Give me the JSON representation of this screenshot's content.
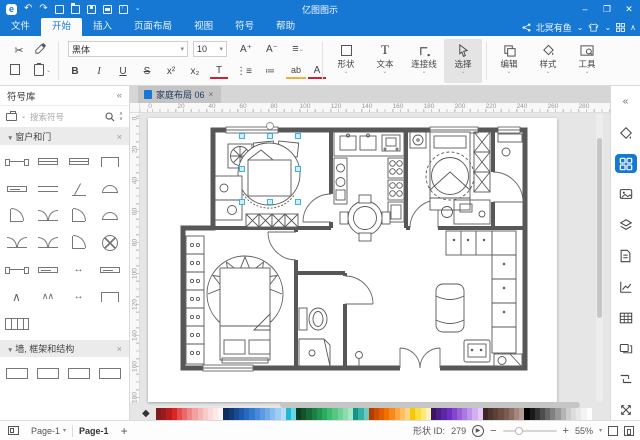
{
  "titlebar": {
    "title": "亿图图示",
    "minimize": "–",
    "maximize": "❐",
    "close": "✕",
    "undo": "↶",
    "redo": "↷"
  },
  "menubar": {
    "tabs": [
      "文件",
      "开始",
      "插入",
      "页面布局",
      "视图",
      "符号",
      "帮助"
    ],
    "active_tab": "开始",
    "user": "北冥有鱼",
    "collapse": "∧"
  },
  "toolbar": {
    "font_name": "黑体",
    "font_size": "10",
    "grow_font": "A⁺",
    "shrink_font": "A⁻",
    "align": "≡",
    "cut": "✂",
    "format": [
      "B",
      "I",
      "U",
      "S",
      "x²",
      "x₂",
      "T",
      "ab",
      "A"
    ],
    "groups": [
      "形状",
      "文本",
      "连接线",
      "选择",
      "编辑",
      "样式",
      "工具"
    ],
    "active_group": "选择"
  },
  "sidebar": {
    "title": "符号库",
    "collapse": "«",
    "search_placeholder": "搜索符号",
    "sections": [
      {
        "label": "窗户和门"
      },
      {
        "label": "墙, 框架和结构"
      }
    ],
    "symbols": [
      "sash",
      "window",
      "window",
      "bay",
      "slider",
      "opening",
      "leaf",
      "halfround",
      "door",
      "double-door",
      "door",
      "halfround",
      "double-door",
      "double-door",
      "door",
      "revolving",
      "sash",
      "slider",
      "arrow",
      "slider",
      "tent",
      "tent2",
      "arrow",
      "bay",
      "frame-grid"
    ],
    "wall_symbols": [
      "frame",
      "frame",
      "frame",
      "frame"
    ]
  },
  "canvas": {
    "tab_label": "家庭布局 06",
    "tab_close": "×",
    "ruler_h": [
      0,
      20,
      40,
      60,
      80,
      100,
      120,
      140,
      160,
      180,
      200,
      220,
      240,
      260,
      280
    ],
    "ruler_v": [
      0,
      20,
      40,
      60,
      80,
      100,
      120,
      140,
      160,
      180
    ]
  },
  "statusbar": {
    "page_menu_label": "Page-1",
    "page_tab": "Page-1",
    "add_page": "+",
    "shape_id_label": "形状 ID:",
    "shape_id_value": "279",
    "zoom_value": "55%",
    "play": "▶"
  },
  "palette": {
    "colors": [
      "#7f1d1d",
      "#991b1b",
      "#b91c1c",
      "#dc2626",
      "#e34d4d",
      "#e96a6a",
      "#ef8585",
      "#f3a0a0",
      "#f6b5b5",
      "#f9caca",
      "#fbdada",
      "#fde8e8",
      "#fef2f2",
      "#0c2d5e",
      "#123a78",
      "#174a92",
      "#1d5aac",
      "#2469c2",
      "#3379cf",
      "#478ad9",
      "#5c9be0",
      "#72ace8",
      "#88bdef",
      "#9ecdf4",
      "#b6def9",
      "#22b8d4",
      "#67d6e8",
      "#0b3d20",
      "#11532c",
      "#176939",
      "#1d7f45",
      "#239552",
      "#2aab5e",
      "#3dbb6e",
      "#57c683",
      "#71d198",
      "#8bdcad",
      "#a5e7c2",
      "#0f9688",
      "#35b0a2",
      "#6cc9bf",
      "#b33c00",
      "#cc4c00",
      "#e05d00",
      "#f07000",
      "#f98a1a",
      "#ffa53d",
      "#ffbf60",
      "#ffd584",
      "#f6c80a",
      "#fbdd3e",
      "#fde97a",
      "#fef4b8",
      "#3b1468",
      "#4c1d85",
      "#5d26a2",
      "#6e30bf",
      "#8246cf",
      "#9660d9",
      "#aa7ae2",
      "#be94eb",
      "#d2aef3",
      "#e6c8fa",
      "#3e2723",
      "#4e342e",
      "#5d4037",
      "#6d4c41",
      "#7d5a50",
      "#8d6e63",
      "#a1887f",
      "#b59990",
      "#000000",
      "#1a1a1a",
      "#333333",
      "#4d4d4d",
      "#666666",
      "#808080",
      "#999999",
      "#b3b3b3",
      "#cccccc",
      "#dddddd",
      "#e8e8e8",
      "#f4f4f4",
      "#ffffff"
    ]
  },
  "accent_color": "#1778d4",
  "selection_color": "#35a8dd"
}
